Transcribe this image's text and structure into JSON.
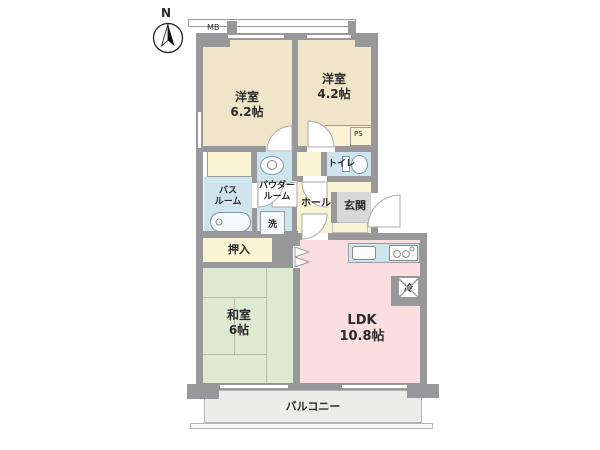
{
  "plan": {
    "type": "japanese-apartment-floor-plan",
    "compass_label": "N",
    "meter_box": "MB",
    "pipe_space": "PS"
  },
  "rooms": {
    "western1": {
      "name": "洋室",
      "size": "6.2帖"
    },
    "western2": {
      "name": "洋室",
      "size": "4.2帖"
    },
    "toilet": {
      "name": "トイレ"
    },
    "bath": {
      "name_line1": "バス",
      "name_line2": "ルーム"
    },
    "powder": {
      "name_line1": "パウダー",
      "name_line2": "ルーム"
    },
    "laundry": {
      "name": "洗"
    },
    "hall": {
      "name": "ホール"
    },
    "entrance": {
      "name": "玄関"
    },
    "closet": {
      "name": "押入"
    },
    "japanese": {
      "name": "和室",
      "size": "6帖"
    },
    "ldk": {
      "name": "LDK",
      "size": "10.8帖"
    },
    "fridge": {
      "name": "冷"
    },
    "balcony": {
      "name": "バルコニー"
    }
  },
  "colors": {
    "wall": "#98989a",
    "western_room": "#f1e5c9",
    "japanese_room": "#dcead2",
    "ldk": "#fbdee0",
    "wet_area": "#cfe5ed",
    "hall_closet": "#faf4d4",
    "entrance_tile": "#d8d8d8",
    "balcony": "#ececea"
  }
}
